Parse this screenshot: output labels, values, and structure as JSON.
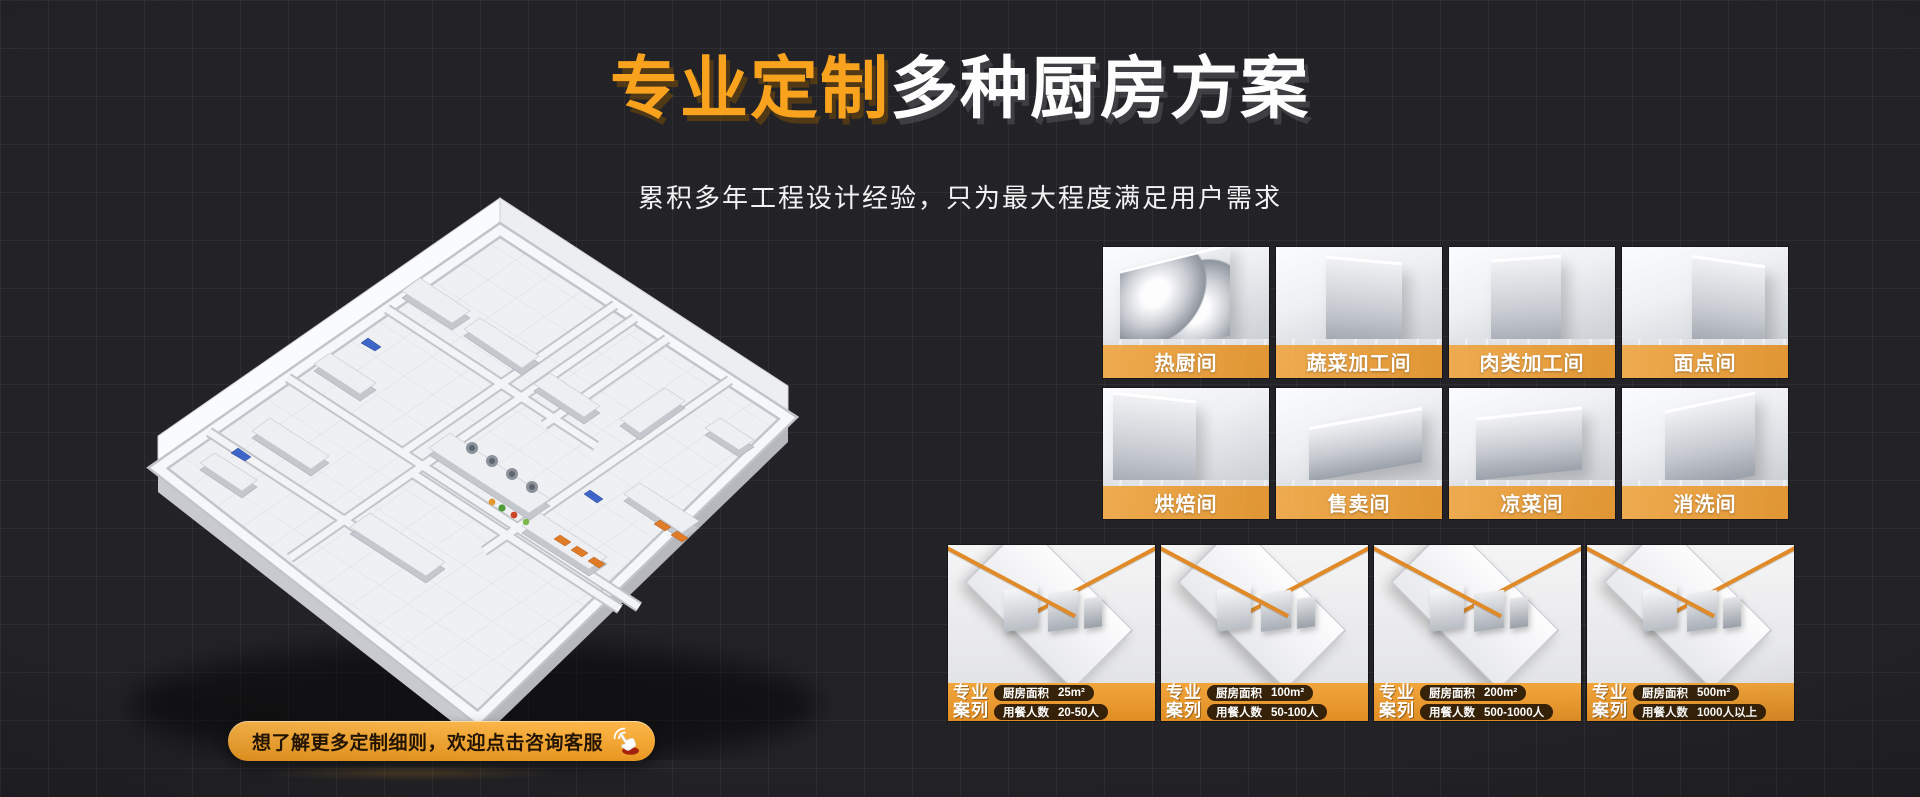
{
  "hero": {
    "title_highlight": "专业定制",
    "title_rest": "多种厨房方案",
    "subtitle": "累积多年工程设计经验，只为最大程度满足用户需求"
  },
  "function_rooms": {
    "items": [
      {
        "label": "热厨间"
      },
      {
        "label": "蔬菜加工间"
      },
      {
        "label": "肉类加工间"
      },
      {
        "label": "面点间"
      },
      {
        "label": "烘焙间"
      },
      {
        "label": "售卖间"
      },
      {
        "label": "凉菜间"
      },
      {
        "label": "消洗间"
      }
    ]
  },
  "cases": {
    "items": [
      {
        "tag_line1": "专业",
        "tag_line2": "案列",
        "area_label": "厨房面积",
        "area_value": "25m²",
        "diners_label": "用餐人数",
        "diners_value": "20-50人"
      },
      {
        "tag_line1": "专业",
        "tag_line2": "案列",
        "area_label": "厨房面积",
        "area_value": "100m²",
        "diners_label": "用餐人数",
        "diners_value": "50-100人"
      },
      {
        "tag_line1": "专业",
        "tag_line2": "案列",
        "area_label": "厨房面积",
        "area_value": "200m²",
        "diners_label": "用餐人数",
        "diners_value": "500-1000人"
      },
      {
        "tag_line1": "专业",
        "tag_line2": "案列",
        "area_label": "厨房面积",
        "area_value": "500m²",
        "diners_label": "用餐人数",
        "diners_value": "1000人以上"
      }
    ]
  },
  "cta": {
    "label": "想了解更多定制细则，欢迎点击咨询客服",
    "icon": "hand-click-icon"
  },
  "illustration": {
    "name": "isometric-kitchen-floorplan"
  },
  "colors": {
    "accent_orange": "#F8A21E",
    "label_bar_orange": "#E89A36",
    "background": "#232327",
    "pill_dark": "#160D02"
  }
}
